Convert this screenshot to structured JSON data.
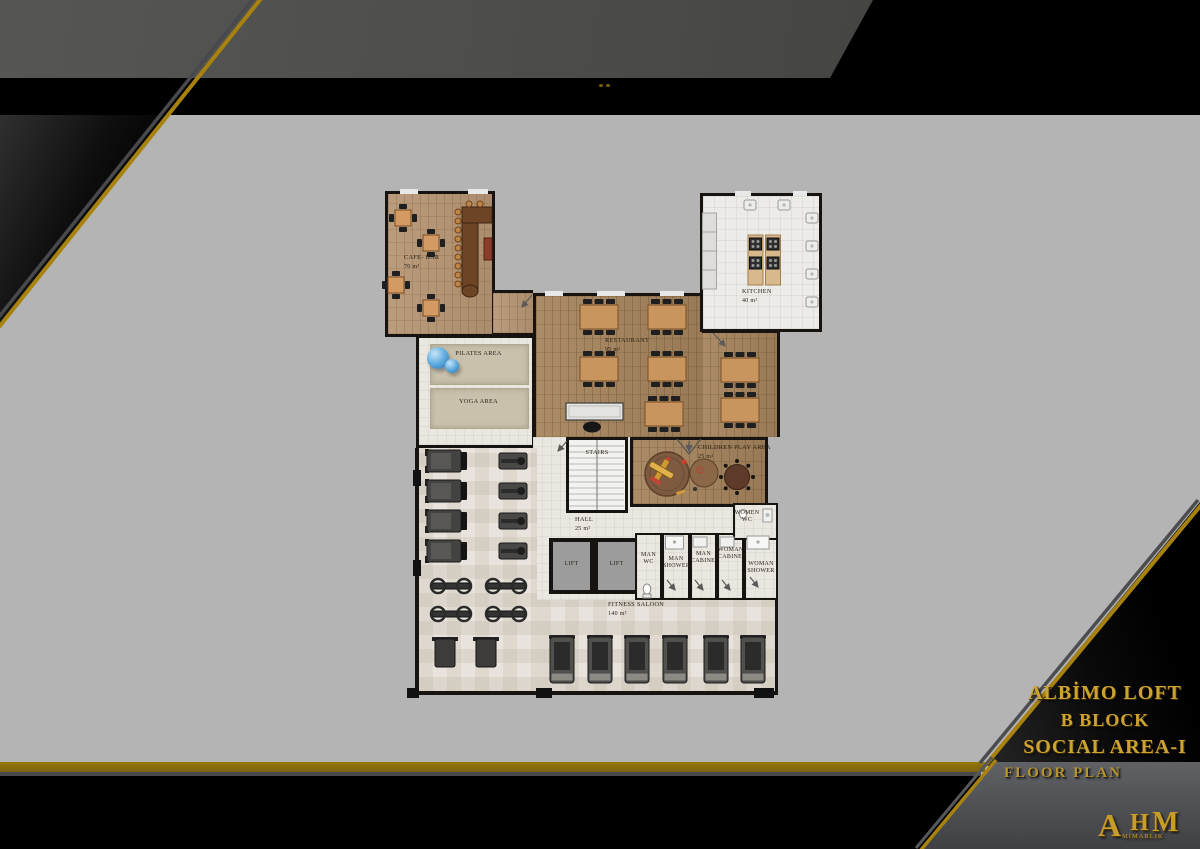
{
  "title_block": {
    "project": "ALBİMO LOFT",
    "block": "B BLOCK",
    "area": "SOCIAL AREA-I",
    "caption": "FLOOR PLAN"
  },
  "logo": {
    "a": "A",
    "h": "H",
    "m": "M",
    "sub": "MİMARLIK"
  },
  "colors": {
    "background_gray": "#b4b4b4",
    "frame_black": "#000000",
    "band_dark_gray": "#4a4a48",
    "accent_gold": "#a8820e",
    "title_gold": "#cda22e",
    "wood_floor": "#a2835f",
    "tile_floor": "#eae7e1"
  },
  "plan": {
    "rooms": [
      {
        "id": "cafe_bar",
        "label": "CAFE- BAR",
        "area": "70 m²"
      },
      {
        "id": "restaurant",
        "label": "RESTAURANT",
        "area": "95 m²"
      },
      {
        "id": "kitchen",
        "label": "KITCHEN",
        "area": "40 m²"
      },
      {
        "id": "pilates",
        "label": "PILATES AREA"
      },
      {
        "id": "yoga",
        "label": "YOGA AREA"
      },
      {
        "id": "stairs",
        "label": "STAIRS"
      },
      {
        "id": "hall",
        "label": "HALL",
        "area": "25 m²"
      },
      {
        "id": "children_play",
        "label": "CHILDREN PLAY AREA",
        "area": "25 m²"
      },
      {
        "id": "lift_a",
        "label": "LIFT"
      },
      {
        "id": "lift_b",
        "label": "LIFT"
      },
      {
        "id": "man_wc",
        "label": "MAN WC"
      },
      {
        "id": "man_shower",
        "label": "MAN SHOWER"
      },
      {
        "id": "man_cabinet",
        "label": "MAN CABINET"
      },
      {
        "id": "woman_cabinet",
        "label": "WOMAN CABINET"
      },
      {
        "id": "woman_shower",
        "label": "WOMAN SHOWER"
      },
      {
        "id": "women_wc",
        "label": "WOMEN WC"
      },
      {
        "id": "fitness",
        "label": "FITNESS SALOON",
        "area": "140 m²"
      }
    ]
  }
}
